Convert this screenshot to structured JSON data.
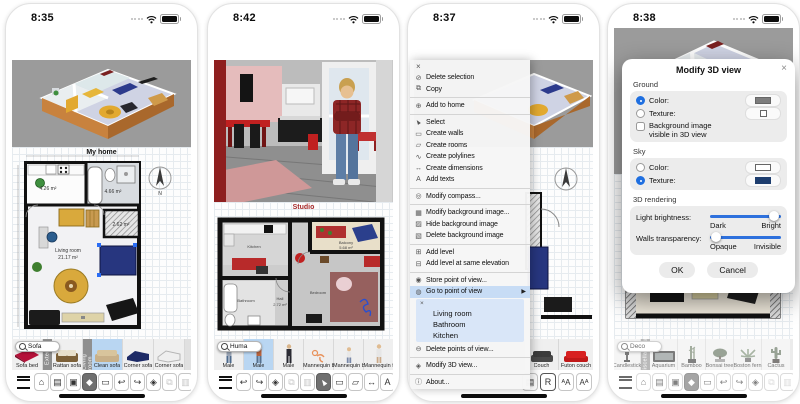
{
  "colors": {
    "accent_blue": "#2e71dd",
    "selection_highlight": "#b9d6f2",
    "menu_highlight": "#c7dcf5",
    "ground_swatch": "#7d7d7d",
    "sky_texture_swatch": "#1d3d6e",
    "toolbar_active": "#6f6f6f"
  },
  "panel1": {
    "time": "8:35",
    "plan": {
      "title": "My home",
      "compass": "N",
      "labels": {
        "kitchen_area": "4.26 m²",
        "bath_area": "4.66 m²",
        "closet_area": "2.62 m²",
        "living_room": "Living room",
        "living_area": "21.17 m²"
      }
    },
    "catalog": {
      "search": "Sofa",
      "tabs": [
        "Exterior",
        "Living room"
      ],
      "items": [
        {
          "label": "Sofa bed"
        },
        {
          "label": "Rattan sofa"
        },
        {
          "label": "Clean sofa"
        },
        {
          "label": "Corner sofa"
        },
        {
          "label": "Corner sofa"
        }
      ]
    },
    "toolbar": [
      {
        "name": "menu",
        "glyph": ""
      },
      {
        "name": "aerial-view",
        "glyph": "⌂"
      },
      {
        "name": "import-background-image",
        "glyph": "▤"
      },
      {
        "name": "photo",
        "glyph": "▣"
      },
      {
        "name": "virtual-visit",
        "glyph": "◆"
      },
      {
        "name": "observer-view",
        "glyph": "▭"
      },
      {
        "name": "undo",
        "glyph": "↩"
      },
      {
        "name": "redo",
        "glyph": "↪"
      },
      {
        "name": "textures",
        "glyph": "◈"
      },
      {
        "name": "copy",
        "glyph": "⧉"
      },
      {
        "name": "paste",
        "glyph": "▥"
      }
    ]
  },
  "panel2": {
    "time": "8:42",
    "plan": {
      "title": "Studio",
      "labels": {
        "kitchen": "Kitchen",
        "bathroom": "Bathroom",
        "hall": "Hall",
        "hall_area": "2.72 m²",
        "bedroom": "Bedroom",
        "balcony": "Balcony",
        "balcony_area": "5.68 m²"
      }
    },
    "catalog": {
      "search": "Huma",
      "items": [
        {
          "label": "Male"
        },
        {
          "label": "Male"
        },
        {
          "label": "Male"
        },
        {
          "label": "Mannequin baby"
        },
        {
          "label": "Mannequin boy"
        },
        {
          "label": "Mannequin female"
        }
      ]
    },
    "toolbar": [
      {
        "name": "menu",
        "glyph": ""
      },
      {
        "name": "undo",
        "glyph": "↩"
      },
      {
        "name": "redo",
        "glyph": "↪"
      },
      {
        "name": "textures",
        "glyph": "◈"
      },
      {
        "name": "copy",
        "glyph": "⧉"
      },
      {
        "name": "paste",
        "glyph": "▥"
      },
      {
        "name": "select",
        "glyph": "▲"
      },
      {
        "name": "create-walls",
        "glyph": "▭"
      },
      {
        "name": "create-rooms",
        "glyph": "▱"
      },
      {
        "name": "create-dimensions",
        "glyph": "↔"
      },
      {
        "name": "add-texts",
        "glyph": "A"
      }
    ]
  },
  "panel3": {
    "time": "8:37",
    "menu": {
      "close": "×",
      "arrow": "▶",
      "items": [
        {
          "label": "Delete selection",
          "glyph": "⊘"
        },
        {
          "label": "Copy",
          "glyph": "⧉"
        },
        {
          "label": "Add to home",
          "glyph": "⊕"
        },
        {
          "label": "Select",
          "glyph": "▲"
        },
        {
          "label": "Create walls",
          "glyph": "▭"
        },
        {
          "label": "Create rooms",
          "glyph": "▱"
        },
        {
          "label": "Create polylines",
          "glyph": "∿"
        },
        {
          "label": "Create dimensions",
          "glyph": "↔"
        },
        {
          "label": "Add texts",
          "glyph": "A"
        },
        {
          "label": "Modify compass...",
          "glyph": "◎"
        },
        {
          "label": "Modify background image...",
          "glyph": "▦"
        },
        {
          "label": "Hide background image",
          "glyph": "▨"
        },
        {
          "label": "Delete background image",
          "glyph": "▧"
        },
        {
          "label": "Add level",
          "glyph": "⊞"
        },
        {
          "label": "Add level at same elevation",
          "glyph": "⊟"
        },
        {
          "label": "Store point of view...",
          "glyph": "◉"
        },
        {
          "label": "Go to point of view",
          "glyph": "◍"
        },
        {
          "label": "Delete points of view...",
          "glyph": "⊖"
        },
        {
          "label": "Modify 3D view...",
          "glyph": "◈"
        },
        {
          "label": "About...",
          "glyph": "ⓘ"
        }
      ],
      "submenu": {
        "close": "×",
        "items": [
          "Living room",
          "Bathroom",
          "Kitchen"
        ]
      }
    },
    "catalog": {
      "items": [
        {
          "label": "Couch"
        },
        {
          "label": "Futon couch"
        }
      ]
    },
    "toolbar": [
      {
        "name": "page-format",
        "glyph": "▤"
      },
      {
        "name": "text-style",
        "glyph": "R"
      },
      {
        "name": "decrease-text-size",
        "glyph": "ᴬA"
      },
      {
        "name": "increase-text-size",
        "glyph": "Aᴬ"
      }
    ]
  },
  "panel4": {
    "time": "8:38",
    "dialog": {
      "title": "Modify 3D view",
      "close": "×",
      "ground": {
        "label": "Ground",
        "color": "Color:",
        "texture": "Texture:",
        "bg_image_line1": "Background image",
        "bg_image_line2": "visible in 3D view"
      },
      "sky": {
        "label": "Sky",
        "color": "Color:",
        "texture": "Texture:"
      },
      "rendering": {
        "label": "3D rendering",
        "brightness": "Light brightness:",
        "dark": "Dark",
        "bright": "Bright",
        "transparency": "Walls transparency:",
        "opaque": "Opaque",
        "invisible": "Invisible"
      },
      "ok": "OK",
      "cancel": "Cancel"
    },
    "catalog": {
      "search": "Deco",
      "tabs": [
        "Miscellaneous"
      ],
      "items": [
        {
          "label": "Candlestick"
        },
        {
          "label": "Aquarium"
        },
        {
          "label": "Bamboo"
        },
        {
          "label": "Bonsai tree"
        },
        {
          "label": "Boston fern"
        },
        {
          "label": "Cactus"
        }
      ]
    },
    "toolbar": [
      {
        "name": "menu",
        "glyph": ""
      },
      {
        "name": "aerial-view",
        "glyph": "⌂"
      },
      {
        "name": "import-background-image",
        "glyph": "▤"
      },
      {
        "name": "photo",
        "glyph": "▣"
      },
      {
        "name": "virtual-visit",
        "glyph": "◆"
      },
      {
        "name": "observer-view",
        "glyph": "▭"
      },
      {
        "name": "undo",
        "glyph": "↩"
      },
      {
        "name": "redo",
        "glyph": "↪"
      },
      {
        "name": "textures",
        "glyph": "◈"
      },
      {
        "name": "copy",
        "glyph": "⧉"
      },
      {
        "name": "paste",
        "glyph": "▥"
      }
    ]
  }
}
